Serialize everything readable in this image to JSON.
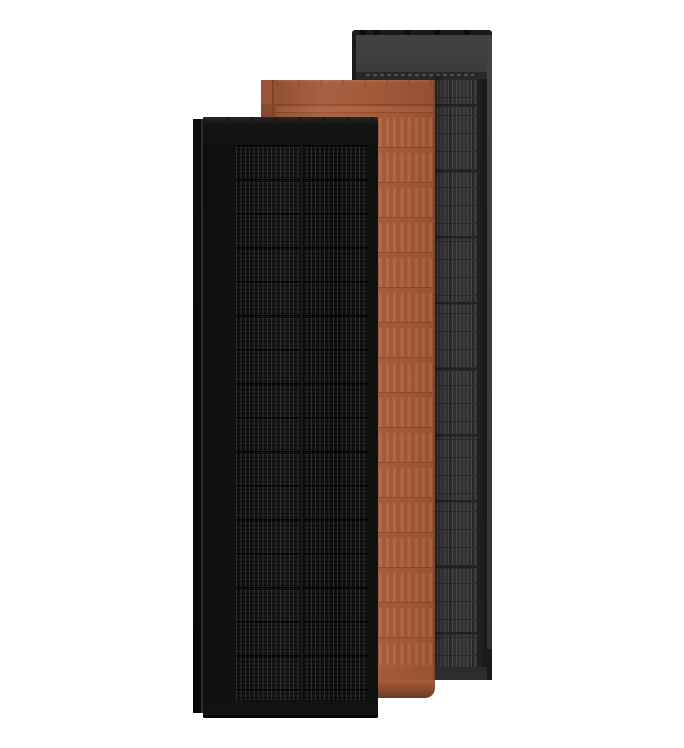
{
  "scene": {
    "name": "solar-shingle-colorways",
    "background": "#ffffff",
    "panels": [
      {
        "name": "shingle-slate-gray",
        "stack_position": "back"
      },
      {
        "name": "shingle-terracotta",
        "stack_position": "middle"
      },
      {
        "name": "shingle-matte-black",
        "stack_position": "front"
      }
    ]
  },
  "colors": {
    "scene-bg": "#ffffff",
    "cast-shadow": "#00000052",
    "gray-frame": "#1b1b1d",
    "gray-topbar": "#19191b",
    "gray-tick": "#0e0e10",
    "gray-header-hi": "#434346",
    "gray-header": "#3b3b3e",
    "gray-vent": "#28282b",
    "gray-ventline": "#525256",
    "gray-cellbg": "#313134",
    "gray-stripe": "#47474a",
    "gray-rowline": "#28282b",
    "gray-thick": "#212124",
    "gray-groupline": "#252528",
    "gray-inshadow1": "#232326",
    "gray-inshadow2": "#17171a",
    "gray-face1": "#424245",
    "gray-face2": "#323235",
    "gray-corner": "#1a1a1c",
    "gray-bottom": "#2c2c2f",
    "terra-flange": "#9a5336",
    "terra-flange-low": "#7e4530",
    "terra-flange-seam": "#7f452a",
    "terra-header": "#a2593a",
    "terra-header-hi": "#b56c46",
    "terra-tick": "#8a4a2c",
    "terra-seam": "#8d4b2c",
    "terra-sub": "#ad603e",
    "terra-base": "#a85c3a",
    "terra-stripe": "#b96b44",
    "terra-rowline": "#8f4e2e",
    "terra-edge": "#7c4227",
    "terra-shadow": "#6b3c25",
    "black-flange1": "#0c0c0c",
    "black-flange2": "#080808",
    "black-flange-seam": "#2b2b2b",
    "black-body": "#101010",
    "black-lip1": "#262626",
    "black-lip2": "#171717",
    "black-header": "#131313",
    "black-cellbg": "#0c0c0c",
    "black-busbar": "#353535",
    "black-divider": "#010101",
    "black-centerseam": "#2a2a2a",
    "black-footer": "#121212",
    "black-bottom": "#050505"
  }
}
